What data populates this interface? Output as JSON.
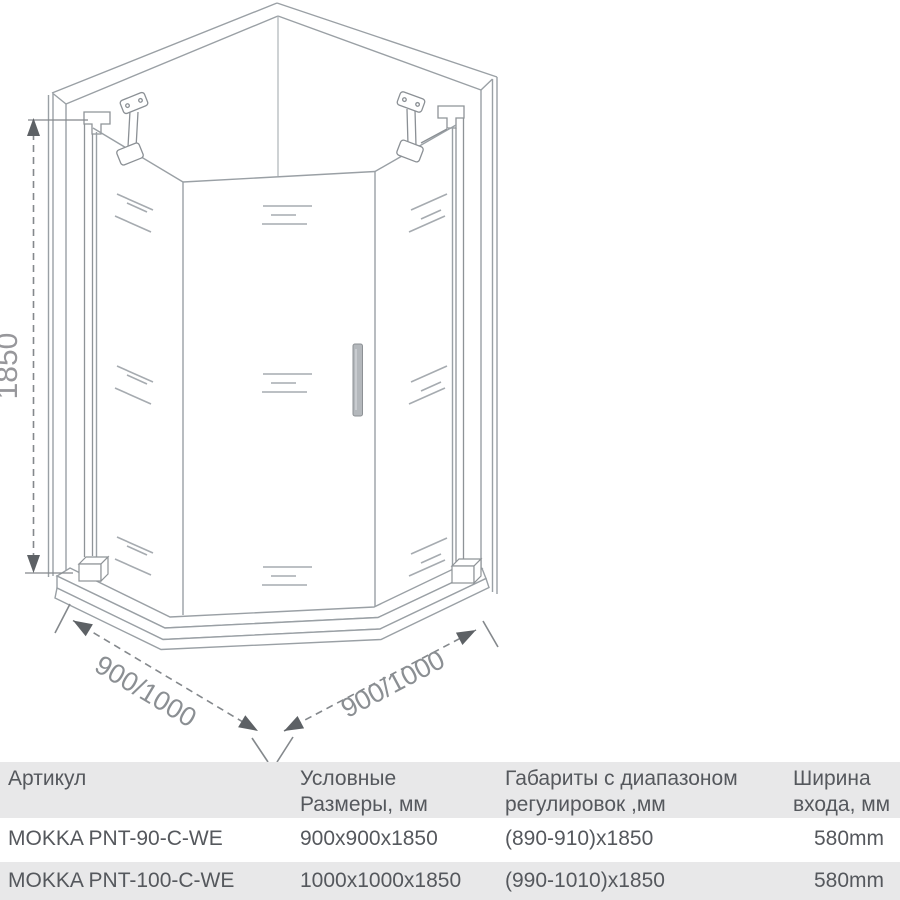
{
  "diagram": {
    "height_dimension": "1850",
    "width_dimension_left": "900/1000",
    "width_dimension_right": "900/1000"
  },
  "table": {
    "header": {
      "col1_line1": "Артикул",
      "col2_line1": "Условные",
      "col2_line2": "Размеры, мм",
      "col3_line1": "Габариты с диапазоном",
      "col3_line2": "регулировок ,мм",
      "col4_line1": "Ширина",
      "col4_line2": "входа, мм"
    },
    "rows": [
      {
        "article": "MOKKA PNT-90-C-WE",
        "nominal_size": "900x900x1850",
        "adjust_range": "(890-910)x1850",
        "entry_width": "580mm"
      },
      {
        "article": "MOKKA PNT-100-C-WE",
        "nominal_size": "1000x1000x1850",
        "adjust_range": "(990-1010)x1850",
        "entry_width": "580mm"
      }
    ]
  },
  "colors": {
    "table_band_gray": "#e8e8e9",
    "table_text": "#55585d",
    "drawing_line": "#9aa0a5",
    "dimension_line": "#84888c",
    "dimension_arrow": "#5d6165",
    "dimension_text": "#8b8f93"
  }
}
